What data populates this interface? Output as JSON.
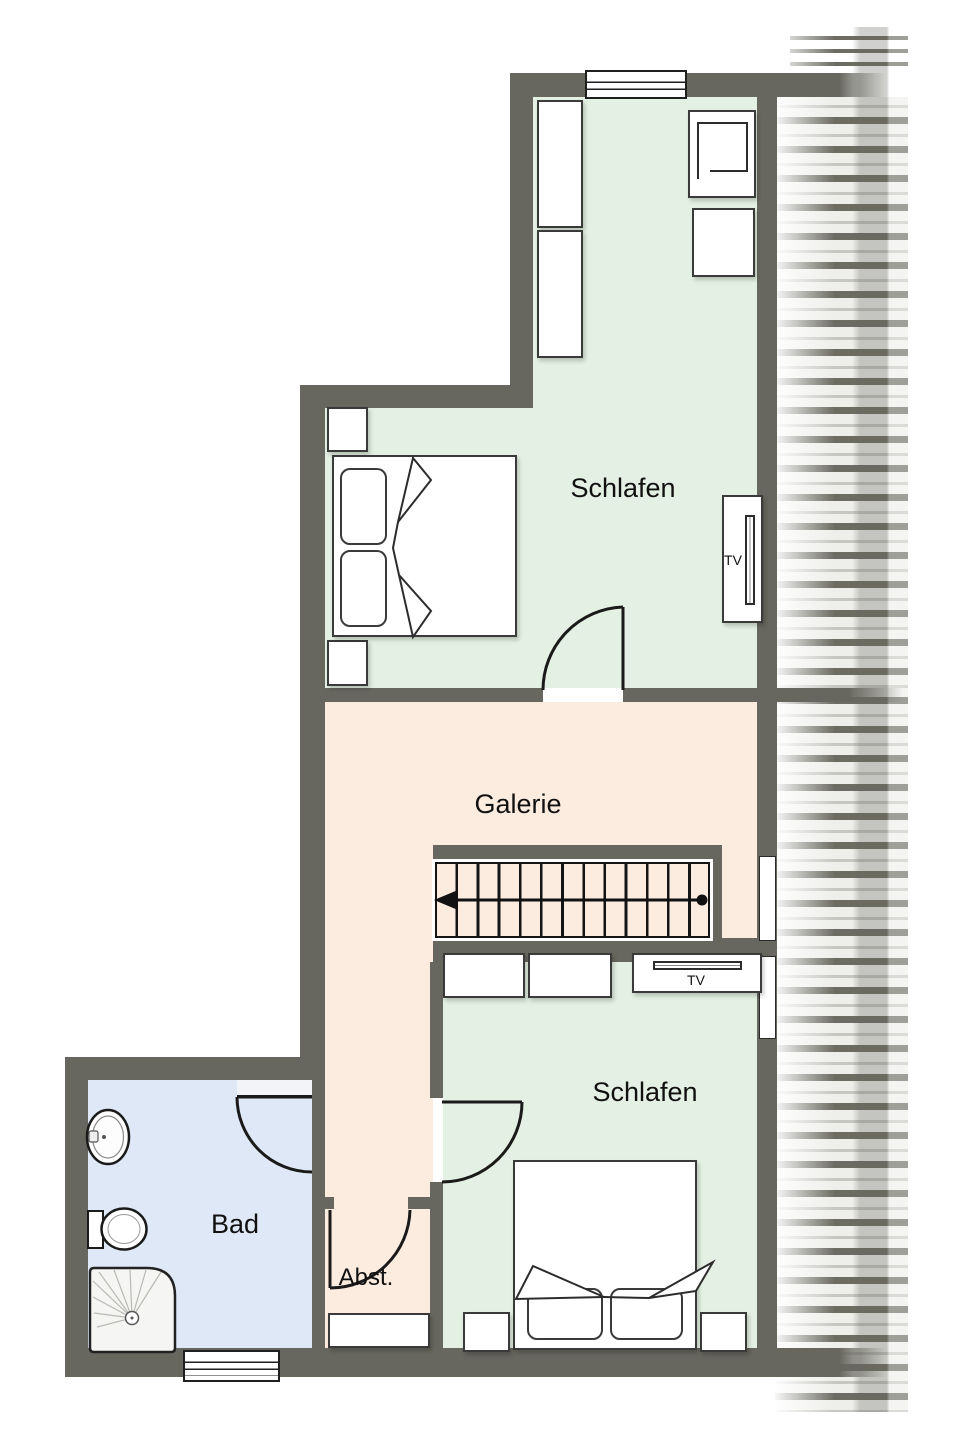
{
  "floorplan": {
    "title_note": "upper floor plan (Dachgeschoss)",
    "tv_label": "TV",
    "rooms": {
      "bedroom_upper": {
        "label": "Schlafen",
        "color": "#e4f0e3",
        "furniture": [
          "double-bed",
          "wardrobe",
          "wardrobe",
          "nightstand",
          "nightstand",
          "armchair",
          "side-table",
          "tv-board"
        ]
      },
      "gallery": {
        "label": "Galerie",
        "color": "#fcecdf",
        "furniture": [
          "staircase-down"
        ]
      },
      "bedroom_lower": {
        "label": "Schlafen",
        "color": "#e4f0e3",
        "furniture": [
          "double-bed",
          "dresser",
          "dresser",
          "nightstand",
          "nightstand",
          "tv-board"
        ]
      },
      "bathroom": {
        "label": "Bad",
        "color": "#dfe8f6",
        "furniture": [
          "sink",
          "toilet",
          "shower"
        ]
      },
      "storage": {
        "label": "Abst.",
        "color": "#fcecdf",
        "furniture": [
          "cabinet"
        ]
      }
    },
    "colors": {
      "wall": "#67675f",
      "outline": "#1a1a1a",
      "roof_stripe": "#6c6c63",
      "roof_base": "#eeeeeb",
      "background": "#ffffff"
    },
    "stairs": {
      "treads": 13,
      "direction_arrow": "left"
    },
    "windows": {
      "top": 1,
      "right": 2,
      "bottom": 1
    }
  }
}
